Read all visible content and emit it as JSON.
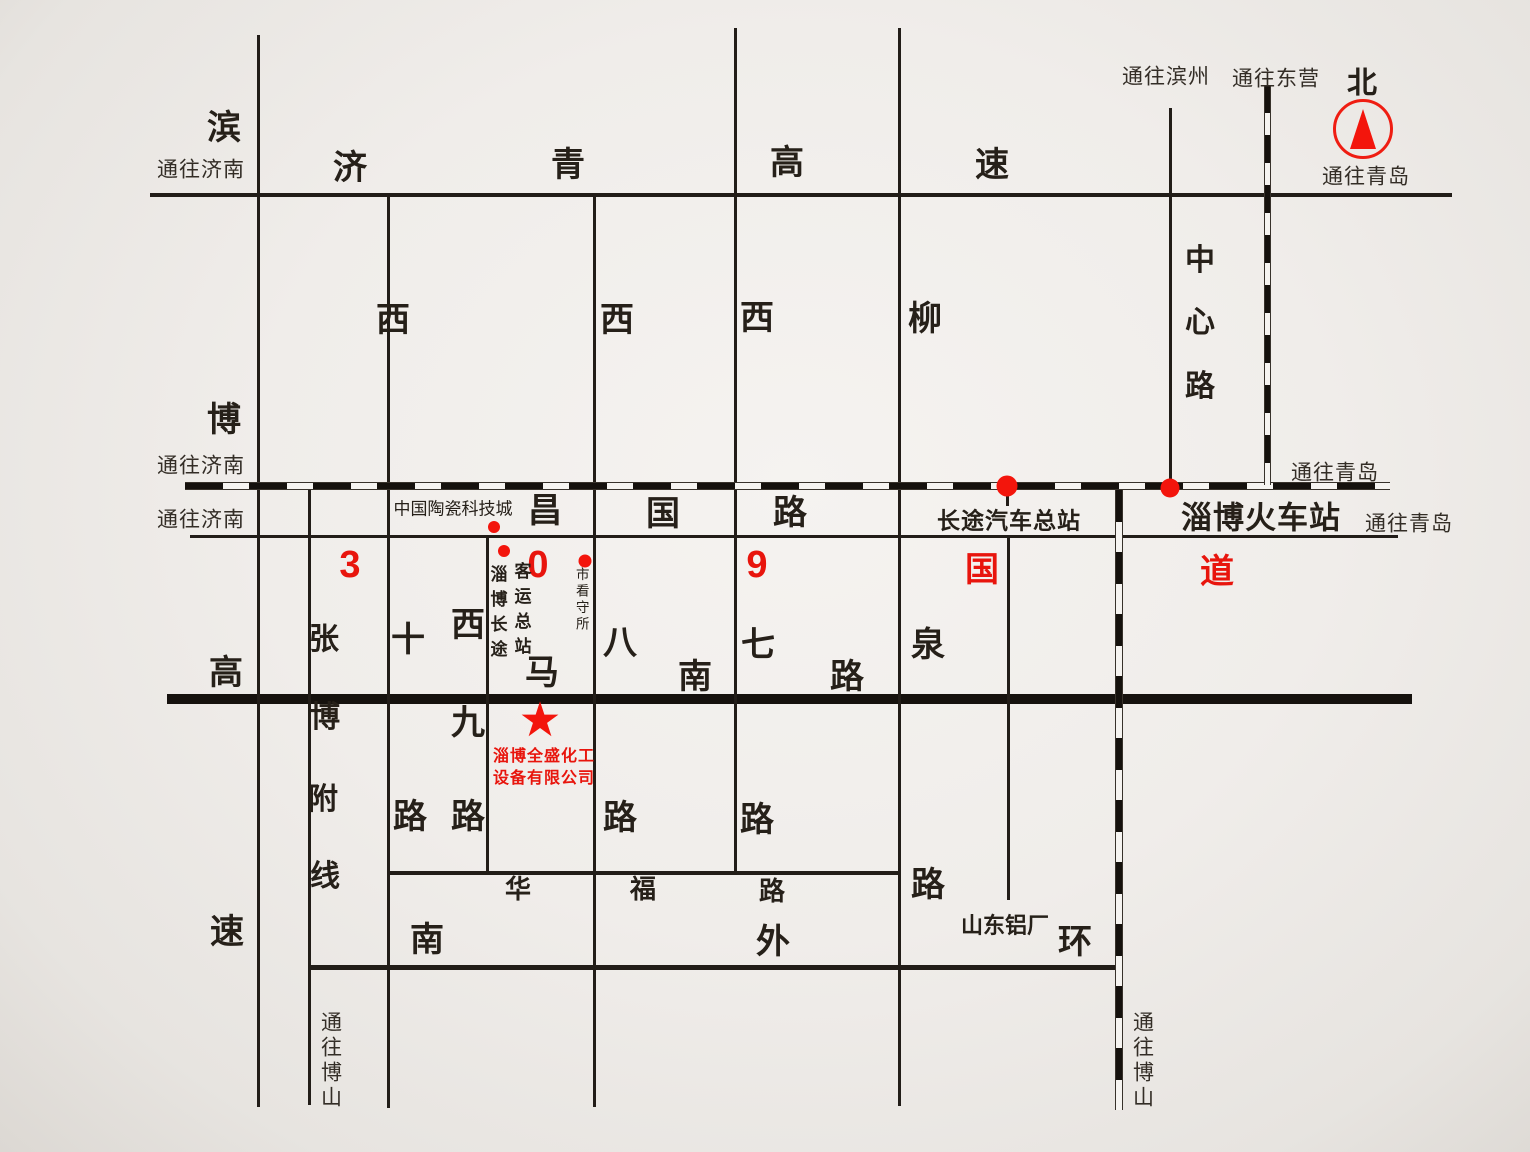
{
  "colors": {
    "ink": "#221d18",
    "red": "#e8150d",
    "paper": "#f0edea"
  },
  "compass": {
    "north": "北"
  },
  "directions": {
    "to_jinan": "通往济南",
    "to_qingdao": "通往青岛",
    "to_binzhou": "通往滨州",
    "to_dongying": "通往东营",
    "to_boshan": "通往博山"
  },
  "roads": {
    "jiqing": {
      "name": "济青高速",
      "chars": [
        "济",
        "青",
        "高",
        "速"
      ]
    },
    "binbo": {
      "name": "滨博高速",
      "chars": [
        "滨",
        "博",
        "高",
        "速"
      ]
    },
    "zhangbo": {
      "name": "张博附线",
      "chars": [
        "张",
        "博",
        "附",
        "线"
      ]
    },
    "changguo": {
      "name": "昌国路",
      "chars": [
        "昌",
        "国",
        "路"
      ]
    },
    "g309": {
      "name": "309国道",
      "chars": [
        "3",
        "0",
        "9",
        "国",
        "道"
      ]
    },
    "xishi": {
      "name": "西十路",
      "chars": [
        "西",
        "十",
        "路"
      ]
    },
    "xijiu": {
      "name": "西九路",
      "chars": [
        "西",
        "九",
        "路"
      ]
    },
    "xiba": {
      "name": "西八路",
      "chars": [
        "西",
        "八",
        "路"
      ]
    },
    "xiqi": {
      "name": "西七路",
      "chars": [
        "西",
        "七",
        "路"
      ]
    },
    "liuquan": {
      "name": "柳泉路",
      "chars": [
        "柳",
        "泉",
        "路"
      ]
    },
    "manan": {
      "name": "马南路",
      "chars": [
        "马",
        "南",
        "路"
      ]
    },
    "zhongxin": {
      "name": "中心路",
      "chars": [
        "中",
        "心",
        "路"
      ]
    },
    "huafu": {
      "name": "华福路",
      "chars": [
        "华",
        "福",
        "路"
      ]
    },
    "nanwaihuan": {
      "name": "南外环",
      "chars": [
        "南",
        "外",
        "环"
      ]
    }
  },
  "pois": {
    "ceramics_city": "中国陶瓷科技城",
    "coach_terminal_col1": "淄博长途",
    "coach_terminal_col2": "客运总站",
    "detention": "市看守所",
    "bus_terminal": "长途汽车总站",
    "train_station": "淄博火车站",
    "aluminum_plant": "山东铝厂",
    "company_line1": "淄博全盛化工",
    "company_line2": "设备有限公司"
  }
}
